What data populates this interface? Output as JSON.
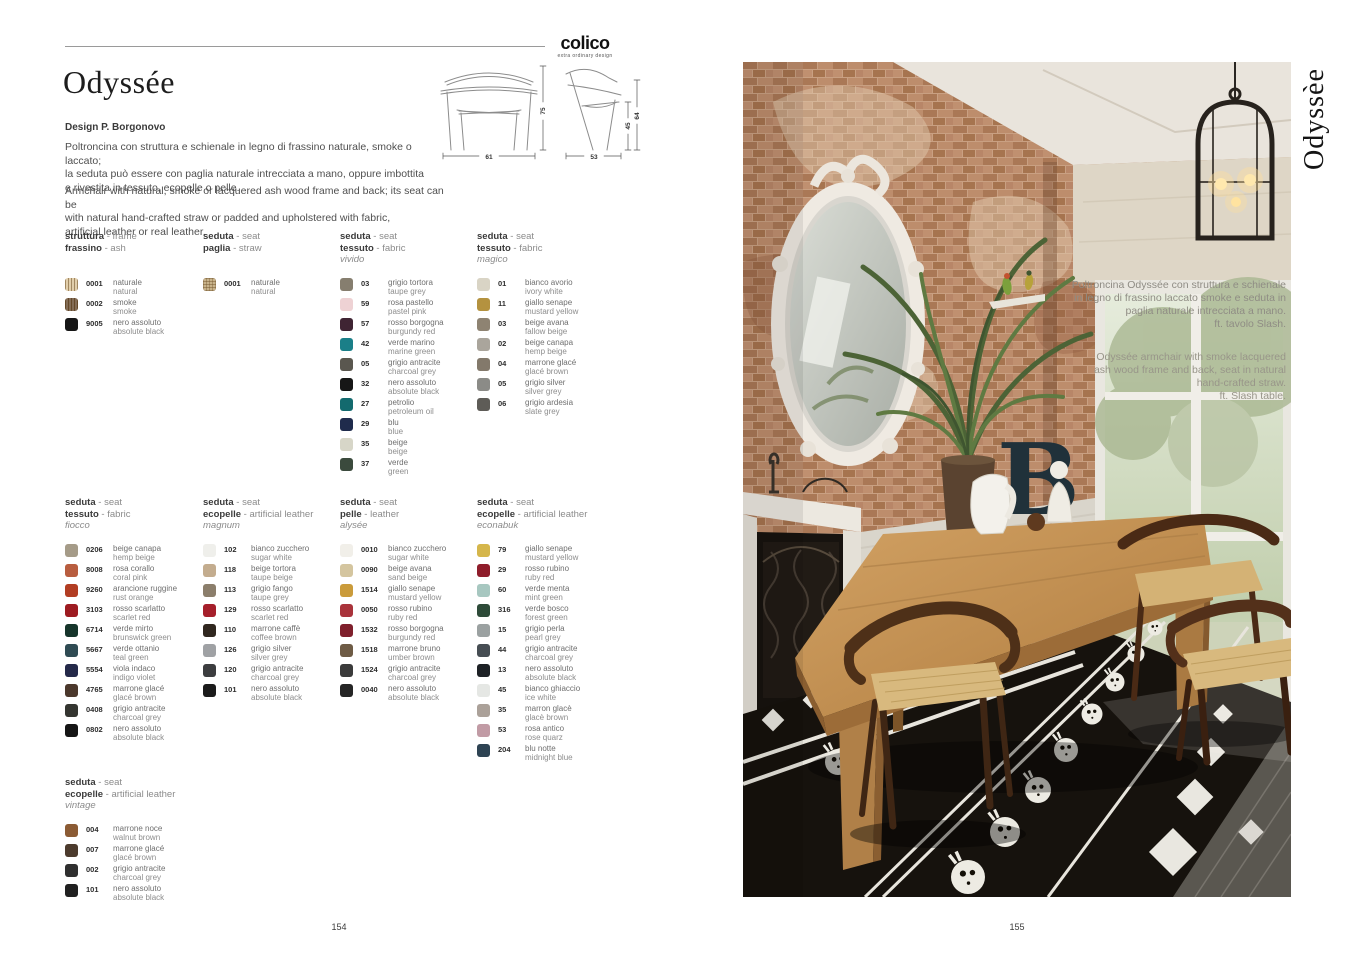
{
  "logo": {
    "name": "colico",
    "tagline": "extra ordinary design"
  },
  "left": {
    "title": "Odyssée",
    "design": "Design P. Borgonovo",
    "desc_it": "Poltroncina con struttura e schienale in legno di frassino naturale, smoke o laccato;\nla seduta può essere con paglia naturale intrecciata a mano, oppure imbottita\ne rivestita in tessuto, ecopelle o pelle.",
    "desc_en": "Armchair with natural, smoke or lacquered ash wood frame and back; its seat can be\nwith natural hand-crafted straw or padded and upholstered with fabric,\nartificial leather or real leather.",
    "diagram": {
      "front_width": "61",
      "side_width": "53",
      "height": "75",
      "seat_height": "45",
      "arm_height": "64"
    },
    "page_number": "154"
  },
  "right": {
    "vertical_title": "Odyssèe",
    "caption_it": "Poltroncina Odyssée con struttura e schienale\nin legno di frassino laccato smoke e seduta in\npaglia naturale intrecciata a mano.\nft. tavolo Slash.",
    "caption_en": "Odyssée armchair with smoke lacquered\nash wood frame and back, seat in natural\nhand-crafted straw.\nft. Slash table.",
    "page_number": "155"
  },
  "swatch_groups": [
    {
      "header": {
        "l1b": "struttura",
        "l1r": " - frame",
        "l2b": "frassino",
        "l2r": " - ash",
        "variant": ""
      },
      "items": [
        {
          "code": "0001",
          "it": "naturale",
          "en": "natural",
          "color": "#dcc69c",
          "texture": "wood"
        },
        {
          "code": "0002",
          "it": "smoke",
          "en": "smoke",
          "color": "#6d5339",
          "texture": "wood"
        },
        {
          "code": "9005",
          "it": "nero assoluto",
          "en": "absolute black",
          "color": "#161616"
        }
      ]
    },
    {
      "header": {
        "l1b": "seduta",
        "l1r": " - seat",
        "l2b": "paglia",
        "l2r": " - straw",
        "variant": ""
      },
      "items": [
        {
          "code": "0001",
          "it": "naturale",
          "en": "natural",
          "color": "#c8b38b",
          "texture": "straw"
        }
      ]
    },
    {
      "header": {
        "l1b": "seduta",
        "l1r": " - seat",
        "l2b": "tessuto",
        "l2r": " - fabric",
        "variant": "vivido"
      },
      "items": [
        {
          "code": "03",
          "it": "grigio tortora",
          "en": "taupe grey",
          "color": "#867e6f"
        },
        {
          "code": "59",
          "it": "rosa pastello",
          "en": "pastel pink",
          "color": "#eed2d4"
        },
        {
          "code": "57",
          "it": "rosso borgogna",
          "en": "burgundy red",
          "color": "#3f2433"
        },
        {
          "code": "42",
          "it": "verde marino",
          "en": "marine green",
          "color": "#1a7f88"
        },
        {
          "code": "05",
          "it": "grigio antracite",
          "en": "charcoal grey",
          "color": "#5a574f"
        },
        {
          "code": "32",
          "it": "nero assoluto",
          "en": "absolute black",
          "color": "#161616"
        },
        {
          "code": "27",
          "it": "petrolio",
          "en": "petroleum oil",
          "color": "#136a6e"
        },
        {
          "code": "29",
          "it": "blu",
          "en": "blue",
          "color": "#1f2b4c"
        },
        {
          "code": "35",
          "it": "beige",
          "en": "beige",
          "color": "#d7d6c8"
        },
        {
          "code": "37",
          "it": "verde",
          "en": "green",
          "color": "#3b4a3d"
        }
      ]
    },
    {
      "header": {
        "l1b": "seduta",
        "l1r": " - seat",
        "l2b": "tessuto",
        "l2r": " - fabric",
        "variant": "magico"
      },
      "items": [
        {
          "code": "01",
          "it": "bianco avorio",
          "en": "ivory white",
          "color": "#d9d4c5"
        },
        {
          "code": "11",
          "it": "giallo senape",
          "en": "mustard yellow",
          "color": "#b4923f"
        },
        {
          "code": "03",
          "it": "beige avana",
          "en": "fallow beige",
          "color": "#8e8372"
        },
        {
          "code": "02",
          "it": "beige canapa",
          "en": "hemp beige",
          "color": "#aaa59c"
        },
        {
          "code": "04",
          "it": "marrone glacé",
          "en": "glacé brown",
          "color": "#83796b"
        },
        {
          "code": "05",
          "it": "grigio silver",
          "en": "silver grey",
          "color": "#8b8b87"
        },
        {
          "code": "06",
          "it": "grigio ardesia",
          "en": "slate grey",
          "color": "#5e5c57"
        }
      ]
    },
    {
      "header": {
        "l1b": "seduta",
        "l1r": " - seat",
        "l2b": "tessuto",
        "l2r": " - fabric",
        "variant": "fiocco"
      },
      "items": [
        {
          "code": "0206",
          "it": "beige canapa",
          "en": "hemp beige",
          "color": "#a59b88"
        },
        {
          "code": "8008",
          "it": "rosa corallo",
          "en": "coral pink",
          "color": "#b85d3f"
        },
        {
          "code": "9260",
          "it": "arancione ruggine",
          "en": "rust orange",
          "color": "#b23d23"
        },
        {
          "code": "3103",
          "it": "rosso scarlatto",
          "en": "scarlet red",
          "color": "#9d1b21"
        },
        {
          "code": "6714",
          "it": "verde mirto",
          "en": "brunswick green",
          "color": "#16352b"
        },
        {
          "code": "5667",
          "it": "verde ottanio",
          "en": "teal green",
          "color": "#2f4b53"
        },
        {
          "code": "5554",
          "it": "viola indaco",
          "en": "indigo violet",
          "color": "#242949"
        },
        {
          "code": "4765",
          "it": "marrone glacé",
          "en": "glacé brown",
          "color": "#4b382c"
        },
        {
          "code": "0408",
          "it": "grigio antracite",
          "en": "charcoal grey",
          "color": "#343530"
        },
        {
          "code": "0802",
          "it": "nero assoluto",
          "en": "absolute black",
          "color": "#151515"
        }
      ]
    },
    {
      "header": {
        "l1b": "seduta",
        "l1r": " - seat",
        "l2b": "ecopelle",
        "l2r": " - artificial leather",
        "variant": "magnum"
      },
      "items": [
        {
          "code": "102",
          "it": "bianco zucchero",
          "en": "sugar white",
          "color": "#efefeb"
        },
        {
          "code": "118",
          "it": "beige tortora",
          "en": "taupe beige",
          "color": "#c3ac8e"
        },
        {
          "code": "113",
          "it": "grigio fango",
          "en": "taupe grey",
          "color": "#8b7e6b"
        },
        {
          "code": "129",
          "it": "rosso scarlatto",
          "en": "scarlet red",
          "color": "#a51f2b"
        },
        {
          "code": "110",
          "it": "marrone caffè",
          "en": "coffee brown",
          "color": "#30271f"
        },
        {
          "code": "126",
          "it": "grigio silver",
          "en": "silver grey",
          "color": "#9fa1a4"
        },
        {
          "code": "120",
          "it": "grigio antracite",
          "en": "charcoal grey",
          "color": "#3c3d3f"
        },
        {
          "code": "101",
          "it": "nero assoluto",
          "en": "absolute black",
          "color": "#1b1b1b"
        }
      ]
    },
    {
      "header": {
        "l1b": "seduta",
        "l1r": " - seat",
        "l2b": "pelle",
        "l2r": " - leather",
        "variant": "alysée"
      },
      "items": [
        {
          "code": "0010",
          "it": "bianco zucchero",
          "en": "sugar white",
          "color": "#f1efe9"
        },
        {
          "code": "0090",
          "it": "beige avana",
          "en": "sand beige",
          "color": "#d4c59f"
        },
        {
          "code": "1514",
          "it": "giallo senape",
          "en": "mustard yellow",
          "color": "#ca9b3b"
        },
        {
          "code": "0050",
          "it": "rosso rubino",
          "en": "ruby red",
          "color": "#a9333b"
        },
        {
          "code": "1532",
          "it": "rosso borgogna",
          "en": "burgundy red",
          "color": "#7f202c"
        },
        {
          "code": "1518",
          "it": "marrone bruno",
          "en": "umber brown",
          "color": "#6e5b45"
        },
        {
          "code": "1524",
          "it": "grigio antracite",
          "en": "charcoal grey",
          "color": "#3b3b3b"
        },
        {
          "code": "0040",
          "it": "nero assoluto",
          "en": "absolute black",
          "color": "#252525"
        }
      ]
    },
    {
      "header": {
        "l1b": "seduta",
        "l1r": " - seat",
        "l2b": "ecopelle",
        "l2r": " - artificial leather",
        "variant": "econabuk"
      },
      "items": [
        {
          "code": "79",
          "it": "giallo senape",
          "en": "mustard yellow",
          "color": "#d5b64b"
        },
        {
          "code": "29",
          "it": "rosso rubino",
          "en": "ruby red",
          "color": "#8f1d2b"
        },
        {
          "code": "60",
          "it": "verde menta",
          "en": "mint green",
          "color": "#a7c7c0"
        },
        {
          "code": "316",
          "it": "verde bosco",
          "en": "forest green",
          "color": "#2e4b39"
        },
        {
          "code": "15",
          "it": "grigio perla",
          "en": "pearl grey",
          "color": "#9ba1a1"
        },
        {
          "code": "44",
          "it": "grigio antracite",
          "en": "charcoal grey",
          "color": "#464d53"
        },
        {
          "code": "13",
          "it": "nero assoluto",
          "en": "absolute black",
          "color": "#1d2125"
        },
        {
          "code": "45",
          "it": "bianco ghiaccio",
          "en": "ice white",
          "color": "#e5e7e4"
        },
        {
          "code": "35",
          "it": "marron glacè",
          "en": "glacè brown",
          "color": "#aba199"
        },
        {
          "code": "53",
          "it": "rosa antico",
          "en": "rose quarz",
          "color": "#c19ba5"
        },
        {
          "code": "204",
          "it": "blu notte",
          "en": "midnight blue",
          "color": "#2e4353"
        }
      ]
    },
    {
      "header": {
        "l1b": "seduta",
        "l1r": " - seat",
        "l2b": "ecopelle",
        "l2r": " - artificial leather",
        "variant": "vintage"
      },
      "items": [
        {
          "code": "004",
          "it": "marrone noce",
          "en": "walnut brown",
          "color": "#8b5b34"
        },
        {
          "code": "007",
          "it": "marrone glacé",
          "en": "glacé brown",
          "color": "#4c3b2d"
        },
        {
          "code": "002",
          "it": "grigio antracite",
          "en": "charcoal grey",
          "color": "#2f2f2f"
        },
        {
          "code": "101",
          "it": "nero assoluto",
          "en": "absolute black",
          "color": "#202020"
        }
      ]
    }
  ]
}
